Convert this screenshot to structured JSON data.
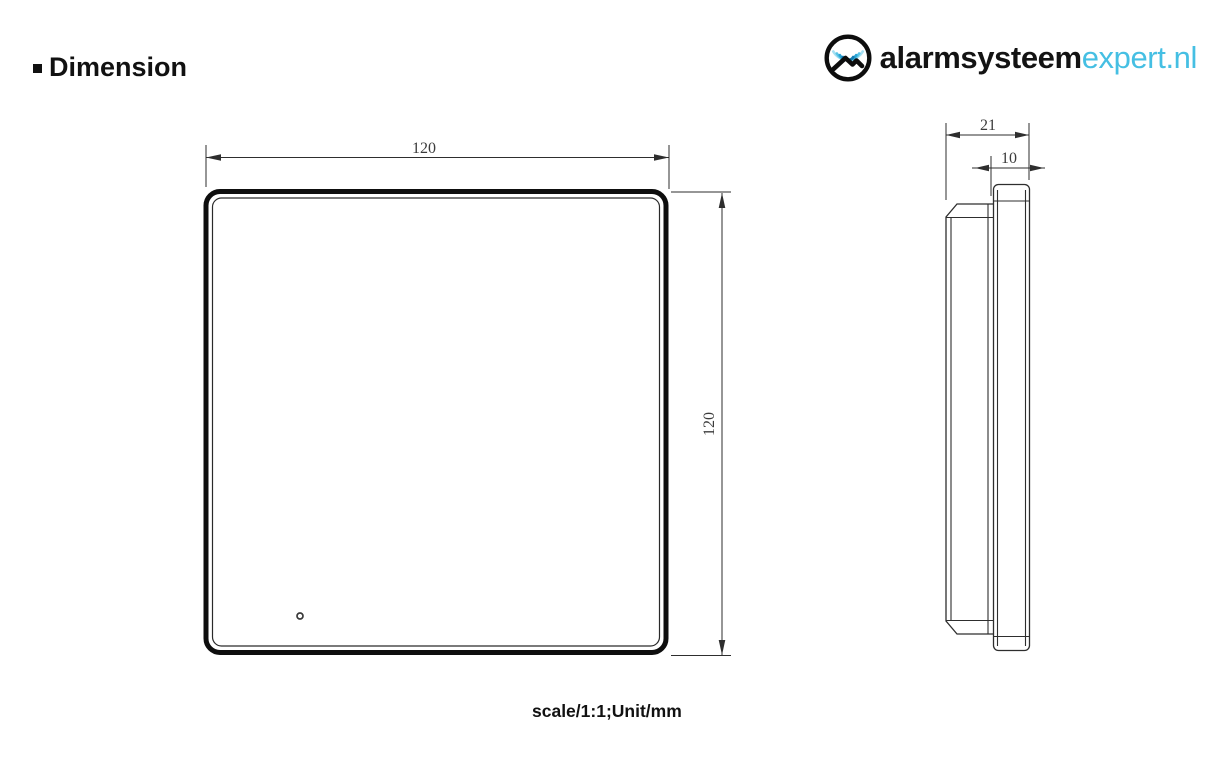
{
  "page": {
    "title": "Dimension",
    "scale_note": "scale/1:1;Unit/mm"
  },
  "logo": {
    "brand_bold": "alarmsysteem",
    "brand_light": "expert.nl",
    "accent_color": "#45bfe3",
    "icon": "wifi-arcs-over-roof-in-circle"
  },
  "drawing": {
    "views": [
      "front view",
      "side view"
    ],
    "front_view": {
      "width_mm": "120",
      "height_mm": "120",
      "feature": "small indicator dot bottom-left"
    },
    "side_view": {
      "total_depth_mm": "21",
      "front_panel_depth_mm": "10"
    },
    "line_color": "#2e2e2e"
  }
}
